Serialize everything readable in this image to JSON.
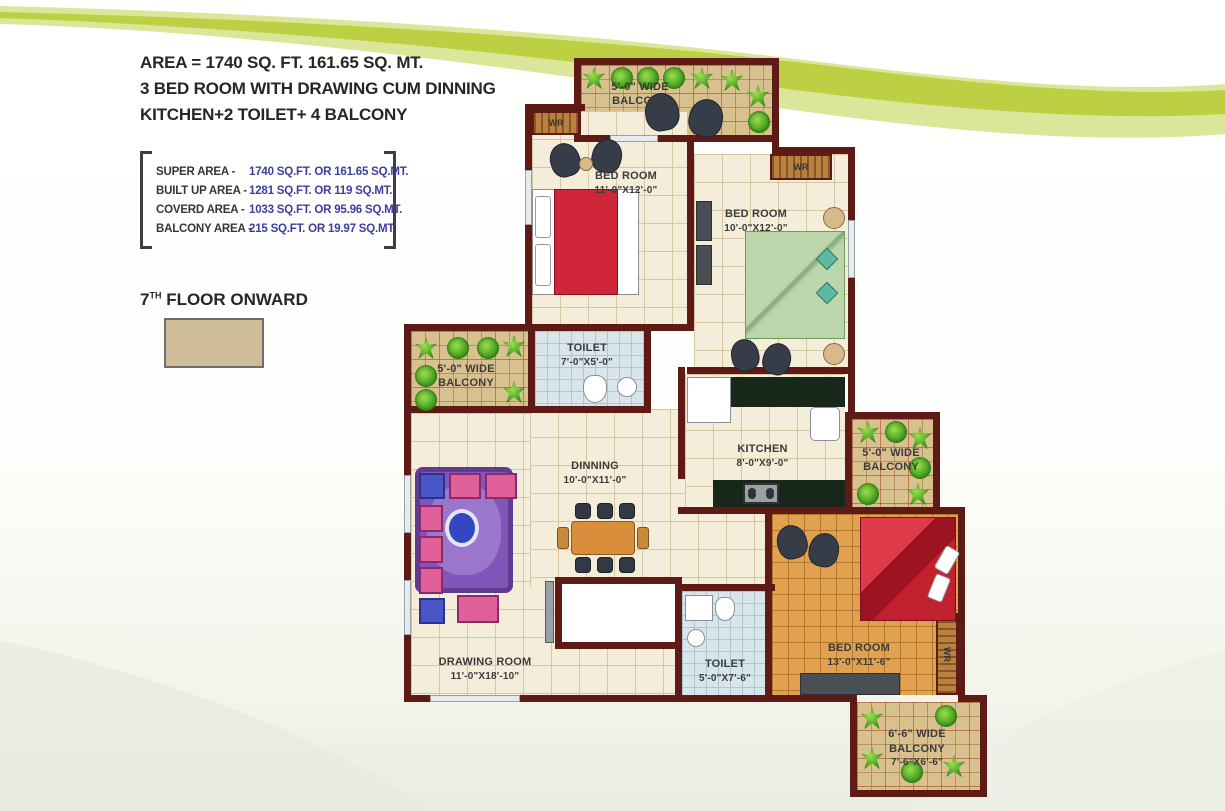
{
  "header": {
    "line1": "AREA  = 1740 SQ. FT. 161.65 SQ. MT.",
    "line2": "3 BED ROOM WITH DRAWING CUM DINNING",
    "line3": "KITCHEN+2 TOILET+ 4 BALCONY"
  },
  "area_details": {
    "rows": [
      {
        "label": "SUPER AREA -",
        "value": "1740 SQ.FT. OR 161.65 SQ.MT."
      },
      {
        "label": "BUILT UP AREA -",
        "value": "1281 SQ.FT. OR 119 SQ.MT."
      },
      {
        "label": "COVERD AREA -",
        "value": "1033 SQ.FT. OR 95.96 SQ.MT."
      },
      {
        "label": "BALCONY AREA -",
        "value": "215 SQ.FT. OR 19.97 SQ.MT."
      }
    ]
  },
  "floor_note": {
    "number": "7",
    "suffix": "TH",
    "label": " FLOOR ONWARD"
  },
  "colors": {
    "wall": "#5e1b16",
    "value_text": "#3d3d9e",
    "floor_swatch": "#cfbd98",
    "swoosh_green": "#bdd044",
    "balcony_floor": "#d9c08f",
    "toilet_floor": "#d8e5ea",
    "bedroom3_floor": "#e1a14e"
  },
  "plan": {
    "bedroom1": {
      "name": "BED ROOM",
      "dims": "11'-0\"X12'-0\""
    },
    "bedroom2": {
      "name": "BED ROOM",
      "dims": "10'-0\"X12'-0\""
    },
    "bedroom3": {
      "name": "BED ROOM",
      "dims": "13'-0\"X11'-6\""
    },
    "toilet1": {
      "name": "TOILET",
      "dims": "7'-0\"X5'-0\""
    },
    "toilet2": {
      "name": "TOILET",
      "dims": "5'-0\"X7'-6\""
    },
    "kitchen": {
      "name": "KITCHEN",
      "dims": "8'-0\"X9'-0\""
    },
    "dinning": {
      "name": "DINNING",
      "dims": "10'-0\"X11'-0\""
    },
    "drawing_room": {
      "name": "DRAWING ROOM",
      "dims": "11'-0\"X18'-10\""
    },
    "balcony_top": {
      "line1": "5'-0\" WIDE",
      "line2": "BALCONY"
    },
    "balcony_left": {
      "line1": "5'-0\" WIDE",
      "line2": "BALCONY"
    },
    "balcony_right": {
      "line1": "5'-0\" WIDE",
      "line2": "BALCONY"
    },
    "balcony_bottom": {
      "line1": "6'-6\" WIDE",
      "line2": "BALCONY",
      "line3": "7'-6\"X6'-6\""
    },
    "wr_label": "WR"
  }
}
